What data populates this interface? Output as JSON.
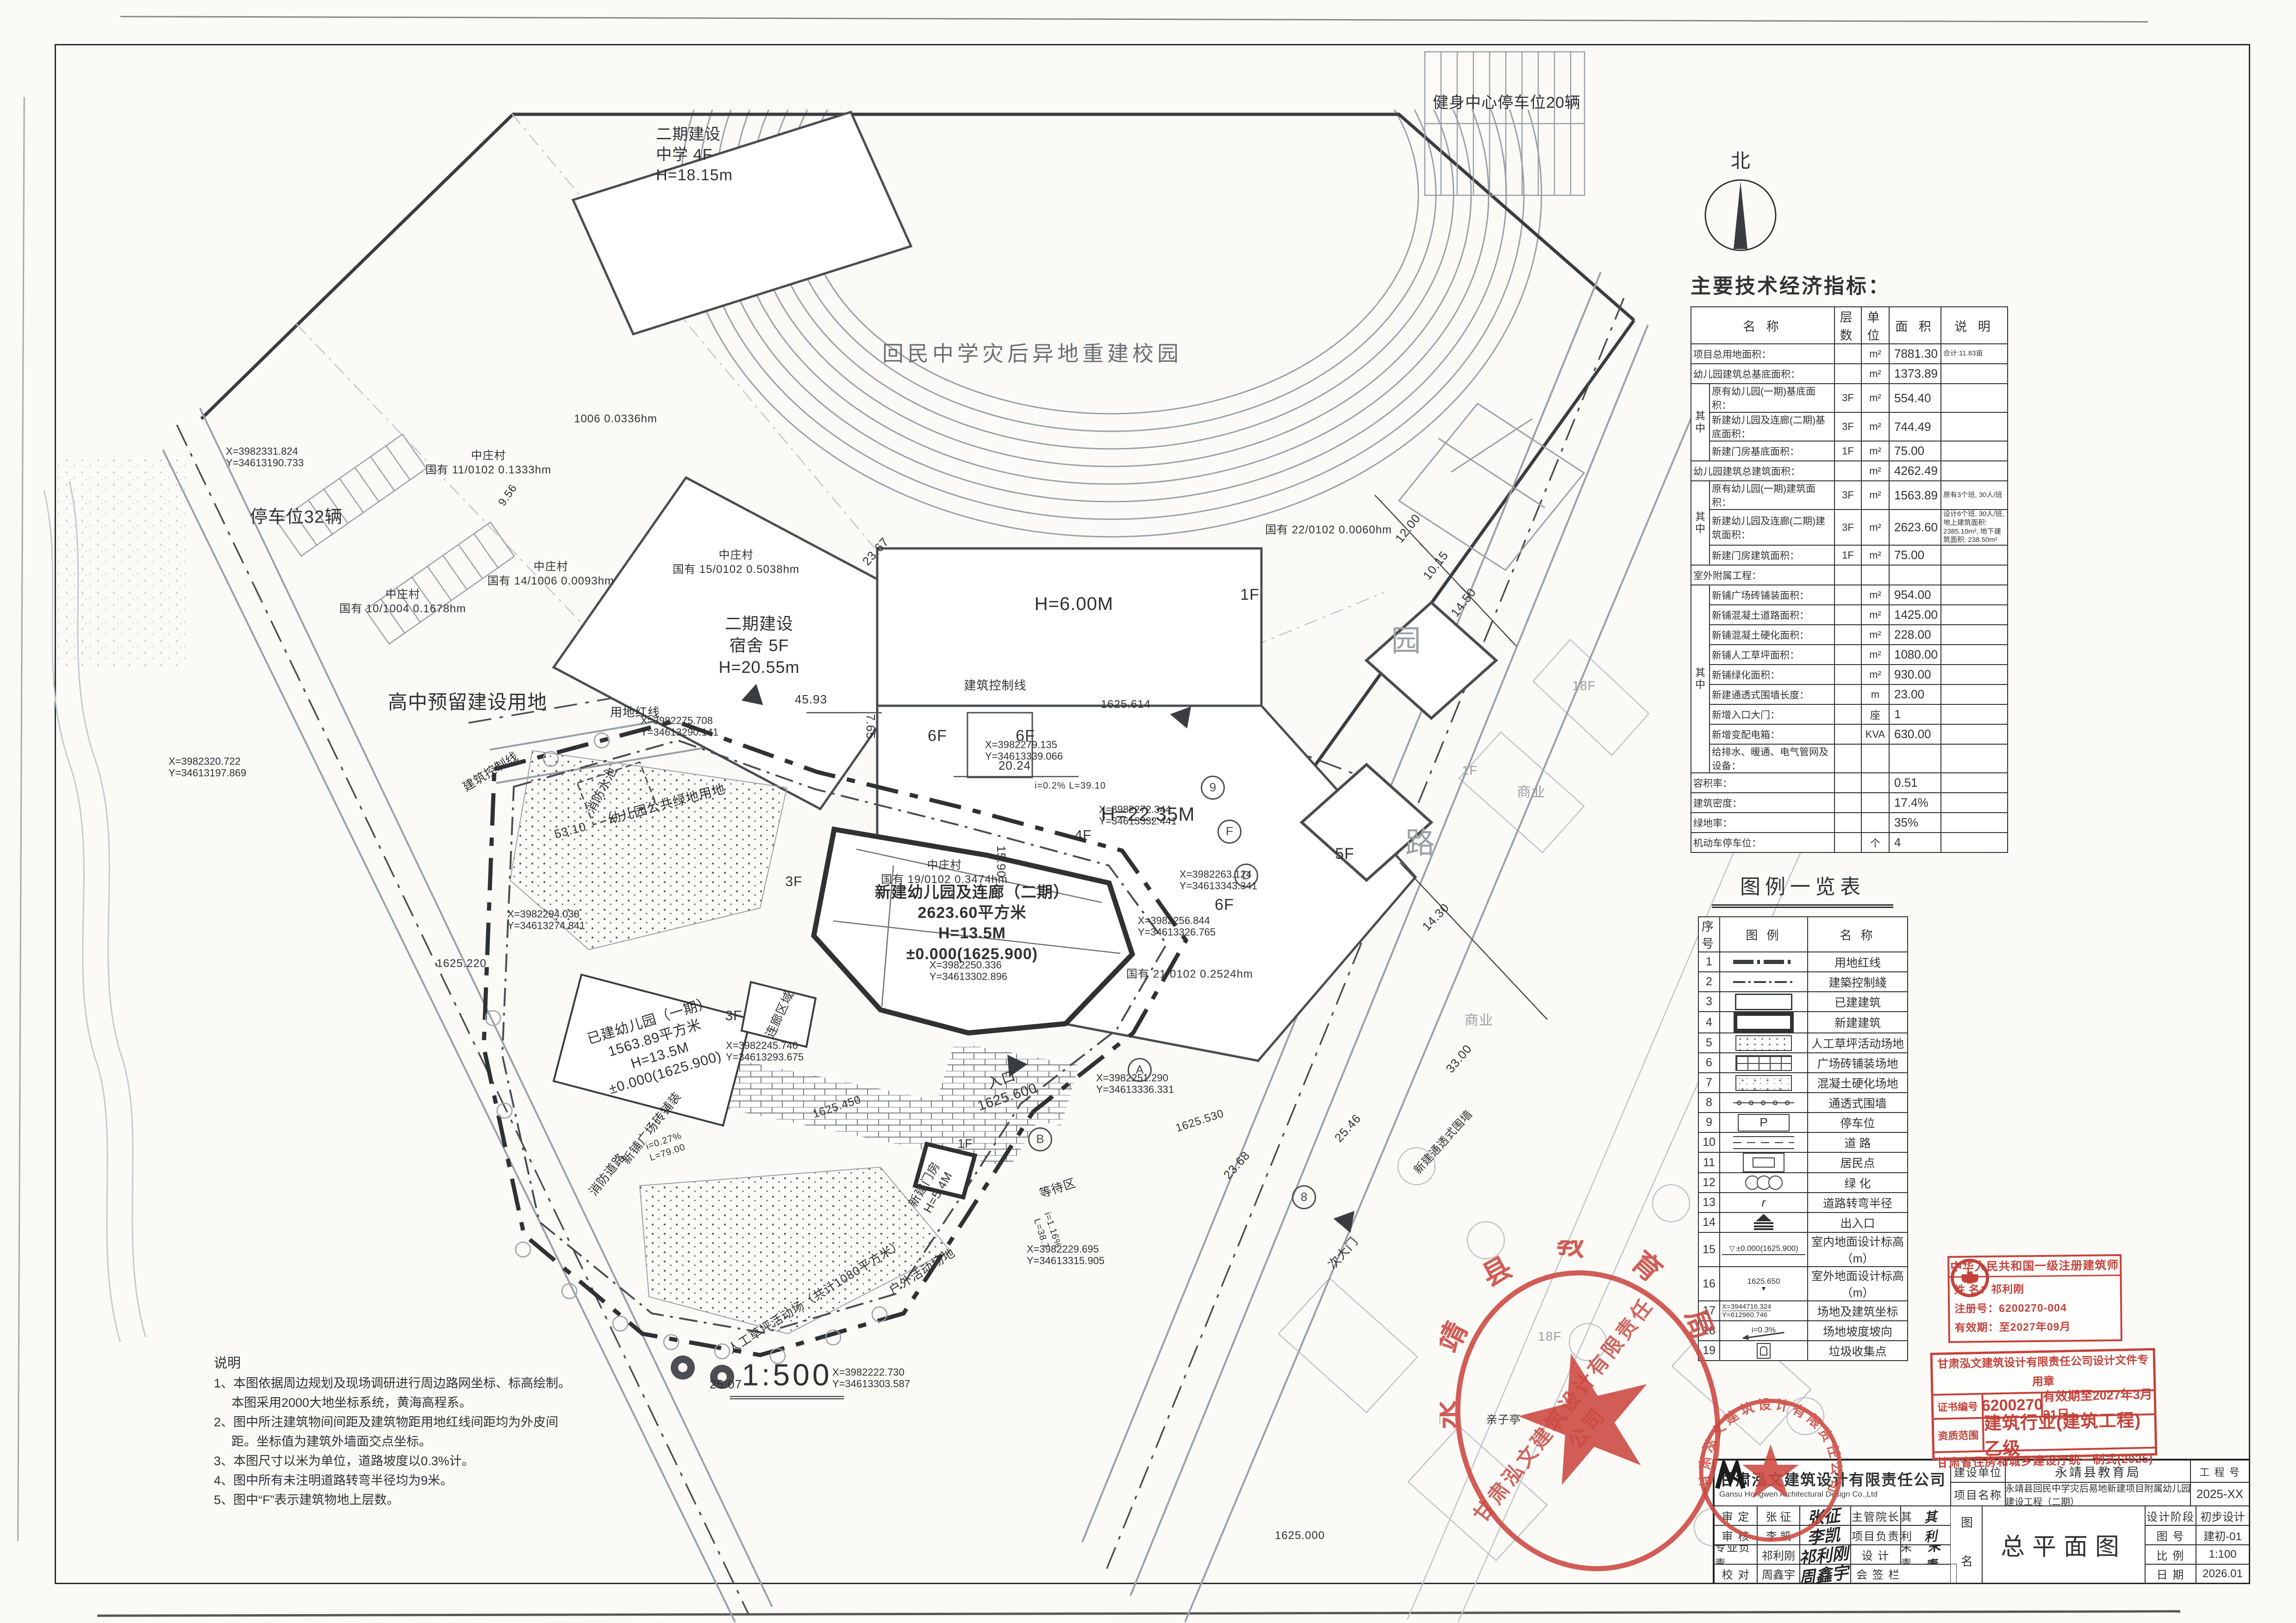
{
  "paper": {
    "scale_label": "1:500"
  },
  "north": {
    "label": "北"
  },
  "plan": {
    "bubbles": [
      "9",
      "F",
      "D",
      "A",
      "B",
      "8"
    ],
    "labels": [
      {
        "t": "回民中学灾后异地重建校园"
      },
      {
        "t": "二期建设\n中学  4F\nH=18.15m"
      },
      {
        "t": "健身中心停车位20辆"
      },
      {
        "t": "二期建设\n宿舍  5F\nH=20.55m"
      },
      {
        "t": "中庄村\n国有 15/0102 0.5038hm"
      },
      {
        "t": "H=6.00M"
      },
      {
        "t": "1F"
      },
      {
        "t": "H=22.35M"
      },
      {
        "t": "6F"
      },
      {
        "t": "6F"
      },
      {
        "t": "6F"
      },
      {
        "t": "5F"
      },
      {
        "t": "中庄村\n国有 19/0102 0.3474hm"
      },
      {
        "t": "国有 21/0102 0.2524hm"
      },
      {
        "t": "国有 22/0102 0.0060hm"
      },
      {
        "t": "中庄村\n国有 10/1004 0.1678hm"
      },
      {
        "t": "中庄村\n国有 14/1006 0.0093hm"
      },
      {
        "t": "中庄村\n国有 11/0102 0.1333hm"
      },
      {
        "t": "1006  0.0336hm"
      },
      {
        "t": "停车位32辆"
      },
      {
        "t": "高中预留建设用地"
      },
      {
        "t": "用地红线"
      },
      {
        "t": "建筑控制线"
      },
      {
        "t": "建筑控制线"
      },
      {
        "t": "幼儿园公共绿地用地"
      },
      {
        "t": "消防水池"
      },
      {
        "t": "新建幼儿园及连廊（二期）\n2623.60平方米\nH=13.5M\n±0.000(1625.900)"
      },
      {
        "t": "4F"
      },
      {
        "t": "3F"
      },
      {
        "t": "3F"
      },
      {
        "t": "连廊区域"
      },
      {
        "t": "已建幼儿园（一期）\n1563.89平方米\nH=13.5M\n±0.000(1625.900)"
      },
      {
        "t": "入口\n1625.600"
      },
      {
        "t": "等待区"
      },
      {
        "t": "新建门房\nH=5.4M"
      },
      {
        "t": "1F"
      },
      {
        "t": "新铺广场砖铺装"
      },
      {
        "t": "消防道路"
      },
      {
        "t": "人工草坪活动场（共计1080平方米）"
      },
      {
        "t": "户外活动场地"
      },
      {
        "t": "次大门"
      },
      {
        "t": "亲子亭"
      },
      {
        "t": "商业"
      },
      {
        "t": "1F"
      },
      {
        "t": "18F"
      },
      {
        "t": "18F"
      },
      {
        "t": "园"
      },
      {
        "t": "路"
      },
      {
        "t": "新建通透式围墙"
      },
      {
        "t": "X=3982331.824\nY=34613190.733"
      },
      {
        "t": "X=3982320.722\nY=34613197.869"
      },
      {
        "t": "X=3982294.038\nY=34613274.841"
      },
      {
        "t": "X=3982275.708\nY=34613290.141"
      },
      {
        "t": "X=3982272.344\nY=34613332.441"
      },
      {
        "t": "X=3982263.124\nY=34613343.341"
      },
      {
        "t": "X=3982251.290\nY=34613336.331"
      },
      {
        "t": "X=3982229.695\nY=34613315.905"
      },
      {
        "t": "X=3982222.730\nY=34613303.587"
      },
      {
        "t": "X=3982279.135\nY=34613339.066"
      },
      {
        "t": "53.10"
      },
      {
        "t": "45.93"
      },
      {
        "t": "20.24"
      },
      {
        "t": "15.90"
      },
      {
        "t": "7.65"
      },
      {
        "t": "23.67"
      },
      {
        "t": "23.68"
      },
      {
        "t": "33.00"
      },
      {
        "t": "25.46"
      },
      {
        "t": "12.00"
      },
      {
        "t": "10.15"
      },
      {
        "t": "14.50"
      },
      {
        "t": "14.30"
      },
      {
        "t": "25.07"
      },
      {
        "t": "1625.450"
      },
      {
        "t": "1625.530"
      },
      {
        "t": "1625.614"
      },
      {
        "t": "1625.000"
      },
      {
        "t": "1625.220"
      },
      {
        "t": "i=0.2%  L=39.10"
      },
      {
        "t": "i=0.27%\nL=79.00"
      },
      {
        "t": "i=1.16%\nL=38.7"
      },
      {
        "t": "9.56"
      },
      {
        "t": "X=3982245.746\nY=34613293.675"
      },
      {
        "t": "X=3982256.844\nY=34613326.765"
      },
      {
        "t": "X=3982250.336\nY=34613302.896"
      },
      {
        "t": "商业"
      }
    ]
  },
  "notes": {
    "title": "说明",
    "lines": [
      "1、本图依据周边规划及现场调研进行周边路网坐标、标高绘制。",
      "本图采用2000大地坐标系统，黄海高程系。",
      "2、图中所注建筑物间间距及建筑物距用地红线间距均为外皮间",
      "距。坐标值为建筑外墙面交点坐标。",
      "3、本图尺寸以米为单位，道路坡度以0.3%计。",
      "4、图中所有未注明道路转弯半径均为9米。",
      "5、图中“F”表示建筑物地上层数。"
    ]
  },
  "econ_table": {
    "title": "主要技术经济指标：",
    "headers": [
      "名    称",
      "层数",
      "单位",
      "面 积",
      "说  明"
    ],
    "zhong_label": "其\n中",
    "rows": [
      {
        "name": "项目总用地面积：",
        "unit": "m²",
        "area": "7881.30",
        "note": "合计:11.83亩"
      },
      {
        "name": "幼儿园建筑总基底面积：",
        "unit": "m²",
        "area": "1373.89"
      },
      {
        "name": "原有幼儿园(一期)基底面积：",
        "floors": "3F",
        "unit": "m²",
        "area": "554.40",
        "qz": 3
      },
      {
        "name": "新建幼儿园及连廊(二期)基底面积：",
        "floors": "3F",
        "unit": "m²",
        "area": "744.49",
        "qz_in": true
      },
      {
        "name": "新建门房基底面积：",
        "floors": "1F",
        "unit": "m²",
        "area": "75.00",
        "qz_in": true
      },
      {
        "name": "幼儿园建筑总建筑面积：",
        "unit": "m²",
        "area": "4262.49"
      },
      {
        "name": "原有幼儿园(一期)建筑面积：",
        "floors": "3F",
        "unit": "m²",
        "area": "1563.89",
        "note": "原有3个班, 30人/班",
        "qz": 3
      },
      {
        "name": "新建幼儿园及连廊(二期)建筑面积：",
        "floors": "3F",
        "unit": "m²",
        "area": "2623.60",
        "note": "设计6个班, 30人/班, 地上建筑面积: 2385.10m², 地下建筑面积: 238.50m²",
        "qz_in": true
      },
      {
        "name": "新建门房建筑面积：",
        "floors": "1F",
        "unit": "m²",
        "area": "75.00",
        "qz_in": true
      },
      {
        "name": "室外附属工程："
      },
      {
        "name": "新铺广场砖铺装面积：",
        "unit": "m²",
        "area": "954.00",
        "qz": 9
      },
      {
        "name": "新铺混凝土道路面积：",
        "unit": "m²",
        "area": "1425.00",
        "qz_in": true
      },
      {
        "name": "新铺混凝土硬化面积：",
        "unit": "m²",
        "area": "228.00",
        "qz_in": true
      },
      {
        "name": "新铺人工草坪面积：",
        "unit": "m²",
        "area": "1080.00",
        "qz_in": true
      },
      {
        "name": "新铺绿化面积：",
        "unit": "m²",
        "area": "930.00",
        "qz_in": true
      },
      {
        "name": "新建通透式围墙长度：",
        "unit": "m",
        "area": "23.00",
        "qz_in": true
      },
      {
        "name": "新增入口大门：",
        "unit": "座",
        "area": "1",
        "qz_in": true
      },
      {
        "name": "新增变配电箱：",
        "unit": "KVA",
        "area": "630.00",
        "qz_in": true
      },
      {
        "name": "给排水、暖通、电气管网及设备：",
        "qz_in": true
      },
      {
        "name": "容积率：",
        "area": "0.51"
      },
      {
        "name": "建筑密度：",
        "area": "17.4%"
      },
      {
        "name": "绿地率：",
        "area": "35%"
      },
      {
        "name": "机动车停车位：",
        "unit": "个",
        "area": "4"
      }
    ]
  },
  "legend": {
    "title": "图例一览表",
    "headers": [
      "序号",
      "图    例",
      "名    称"
    ],
    "rows": [
      {
        "no": "1",
        "sym": "redline",
        "name": "用地红线"
      },
      {
        "no": "2",
        "sym": "ctrl",
        "name": "建築控制綫"
      },
      {
        "no": "3",
        "sym": "existing",
        "name": "已建建筑"
      },
      {
        "no": "4",
        "sym": "newbld",
        "name": "新建建筑"
      },
      {
        "no": "5",
        "sym": "lawn",
        "name": "人工草坪活动场地"
      },
      {
        "no": "6",
        "sym": "brick",
        "name": "广场砖铺装场地"
      },
      {
        "no": "7",
        "sym": "concrete",
        "name": "混凝土硬化场地"
      },
      {
        "no": "8",
        "sym": "fence",
        "name": "通透式围墙"
      },
      {
        "no": "9",
        "sym": "parking",
        "sym_text": "P",
        "name": "停车位"
      },
      {
        "no": "10",
        "sym": "road",
        "name": "道  路"
      },
      {
        "no": "11",
        "sym": "resident",
        "name": "居民点"
      },
      {
        "no": "12",
        "sym": "green",
        "name": "绿  化"
      },
      {
        "no": "13",
        "sym": "radius",
        "sym_text": "r",
        "name": "道路转弯半径"
      },
      {
        "no": "14",
        "sym": "entrance",
        "name": "出入口"
      },
      {
        "no": "15",
        "sym": "elev_in",
        "sym_text": "±0.000(1625.900)",
        "name": "室内地面设计标高（m）"
      },
      {
        "no": "16",
        "sym": "elev_out",
        "sym_text": "1625.650",
        "name": "室外地面设计标高（m）"
      },
      {
        "no": "17",
        "sym": "coords",
        "sym_text": "X=3944716.324",
        "sym_text2": "Y=612960.746",
        "name": "场地及建筑坐标"
      },
      {
        "no": "18",
        "sym": "slope",
        "sym_text": "i=0.3%",
        "name": "场地坡度坡向"
      },
      {
        "no": "19",
        "sym": "trash",
        "name": "垃圾收集点"
      }
    ]
  },
  "titleblock": {
    "company_cn": "甘肃泓文建筑设计有限责任公司",
    "company_en": "Gansu Hongwen Architectural Design  Co.,Ltd",
    "shending_label": "审    定",
    "shending_name": "张  征",
    "shending_sig": "张征",
    "zhuguan_label": "主管院长",
    "zhuguan_name": "郑其荣",
    "zhuguan_sig": "郑其荣",
    "shenhe_label": "审    核",
    "shenhe_name": "李  凯",
    "shenhe_sig": "李凯",
    "xiangmu_label": "项目负责",
    "xiangmu_name": "祁利刚",
    "xiangmu_sig": "祁利刚",
    "zhuanye_label": "专业负责",
    "zhuanye_name": "祁利刚",
    "zhuanye_sig": "祁利刚",
    "sheji_label": "设    计",
    "sheji_name": "朱  青",
    "sheji_sig": "朱青",
    "jiaodui_label": "校    对",
    "jiaodui_name": "周鑫宇",
    "jiaodui_sig": "周鑫宇",
    "huiqian_label": "会 签 栏",
    "jianshe_label": "建设单位",
    "jianshe_value": "永靖县教育局",
    "gongchenghao_label": "工 程 号",
    "project_label": "项目名称",
    "project_value": "永靖县回民中学灾后易地新建项目附属幼儿园建设工程（二期）",
    "project_no": "2025-XX",
    "tuming_label": "图 名",
    "tuming_value": "总平面图",
    "stage_label": "设计阶段",
    "stage_value": "初步设计",
    "tuhao_label": "图    号",
    "tuhao_value": "建初-01",
    "scale_label": "比    例",
    "scale_value": "1:100",
    "date_label": "日    期",
    "date_value": "2026.01"
  },
  "arch_stamp": {
    "title": "中华人民共和国一级注册建筑师",
    "name_label": "姓  名：",
    "name": "祁利刚",
    "reg_label": "注册号：",
    "reg": "6200270-004",
    "valid_label": "有效期：",
    "valid": "至2027年09月"
  },
  "cert_stamp": {
    "line1": "甘肃泓文建筑设计有限责任公司设计文件专用章",
    "no_label": "证书编号",
    "no": "6200270",
    "valid": "有效期至2027年3月31日",
    "scope_label": "资质范围",
    "scope": "建筑行业(建筑工程)乙级",
    "footer": "甘肃省住房和城乡建设厅统一制式(2025)"
  },
  "stamps": {
    "edu": "永靖县教育局",
    "design": "甘肃泓文建筑设计有限责任公司",
    "diagonal": "甘肃泓文建筑设计有限责任公司"
  },
  "icons": {
    "tri_open": "▽",
    "tri_solid": "▼"
  }
}
